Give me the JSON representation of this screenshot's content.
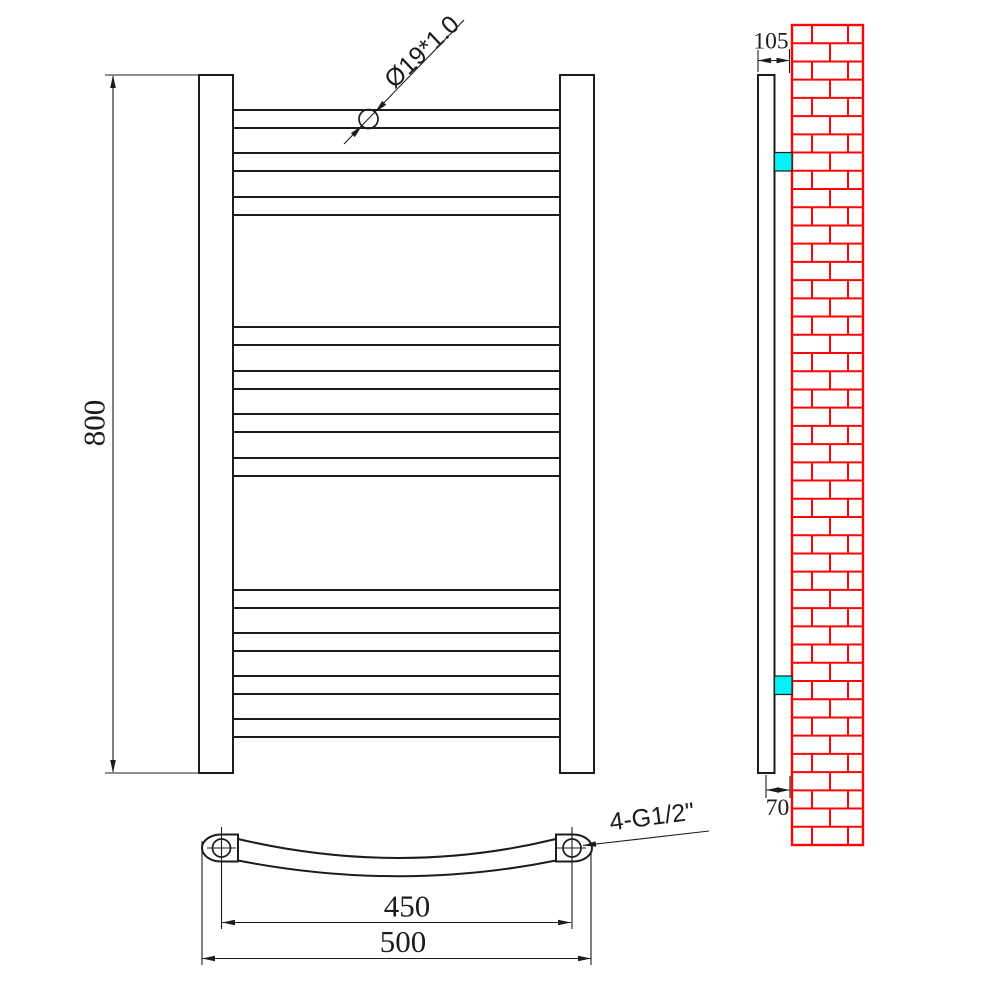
{
  "drawing_type": "towel-radiator-dimension-drawing",
  "front_view": {
    "height_label": "800",
    "tube_label": "Ø19*1.0",
    "bar_count": 11,
    "bar_tops": [
      110,
      153,
      197,
      327,
      371,
      414,
      458,
      590,
      633,
      676,
      719
    ],
    "bar_height": 18
  },
  "top_view": {
    "centers_label": "450",
    "width_label": "500",
    "thread_label": "4-G1/2\""
  },
  "side_view": {
    "depth_label": "105",
    "offset_label": "70",
    "wall_rows": 45,
    "joint_offsets_even": [
      20,
      56
    ],
    "joint_offsets_odd": [
      38
    ]
  },
  "colors": {
    "line": "#1c1c1c",
    "brick": "#fb0707",
    "bracket": "#00f2f2"
  }
}
